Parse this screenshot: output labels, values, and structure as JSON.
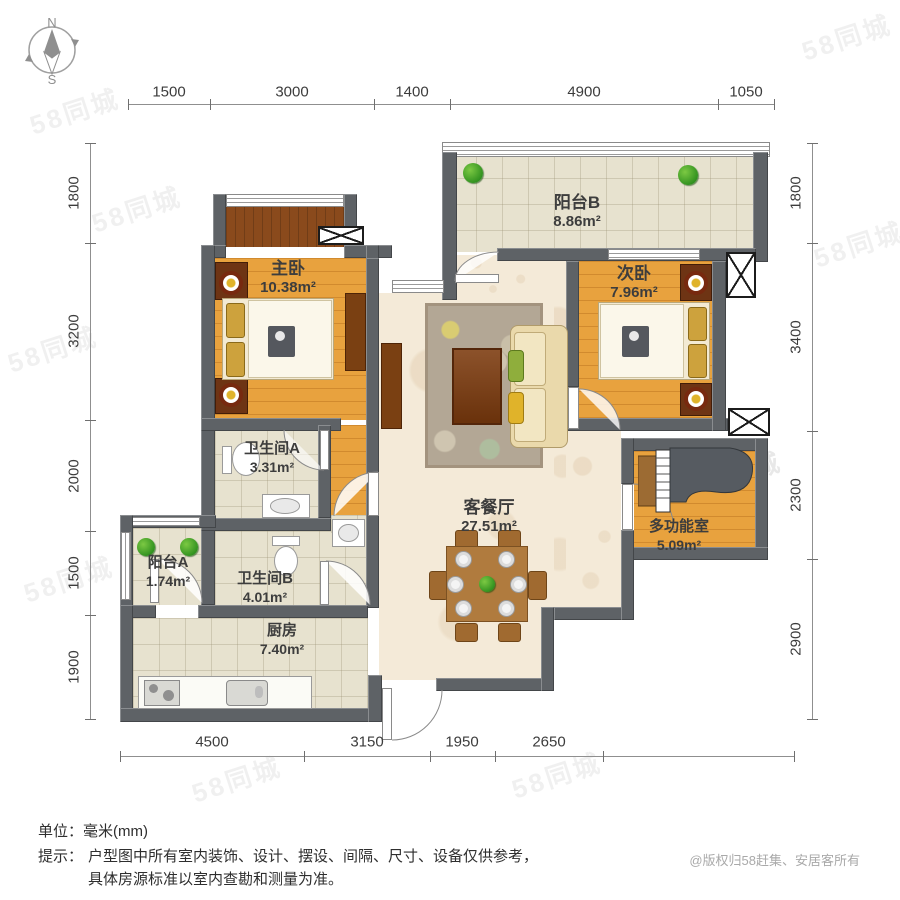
{
  "compass": {
    "north": "N",
    "south": "S"
  },
  "dimensions": {
    "top": [
      "1500",
      "3000",
      "1400",
      "4900",
      "1050"
    ],
    "left": [
      "1800",
      "3200",
      "2000",
      "1500",
      "1900"
    ],
    "right": [
      "1800",
      "3400",
      "2300",
      "2900"
    ],
    "bottom": [
      "4500",
      "3150",
      "1950",
      "2650"
    ]
  },
  "rooms": {
    "balcony_b": {
      "name": "阳台B",
      "area": "8.86m²"
    },
    "bedroom_second": {
      "name": "次卧",
      "area": "7.96m²"
    },
    "bedroom_master": {
      "name": "主卧",
      "area": "10.38m²"
    },
    "living_dining": {
      "name": "客餐厅",
      "area": "27.51m²"
    },
    "bathroom_a": {
      "name": "卫生间A",
      "area": "3.31m²"
    },
    "bathroom_b": {
      "name": "卫生间B",
      "area": "4.01m²"
    },
    "balcony_a": {
      "name": "阳台A",
      "area": "1.74m²"
    },
    "kitchen": {
      "name": "厨房",
      "area": "7.40m²"
    },
    "multi_room": {
      "name": "多功能室",
      "area": "5.09m²"
    }
  },
  "footer": {
    "unit_line": "单位：毫米(mm)",
    "tip_label": "提示：",
    "tip_line1": "户型图中所有室内装饰、设计、摆设、间隔、尺寸、设备仅供参考，",
    "tip_line2": "具体房源标准以室内查勘和测量为准。",
    "copyright": "@版权归58赶集、安居客所有"
  },
  "watermark": "58同城",
  "colors": {
    "wall": "#5e6266",
    "wood_floor": "#e8a23e",
    "tile_floor": "#e7e2cf",
    "living_floor": "#f4ead8",
    "dark_wood": "#7a4012",
    "plant_green": "#2e8f1e"
  }
}
